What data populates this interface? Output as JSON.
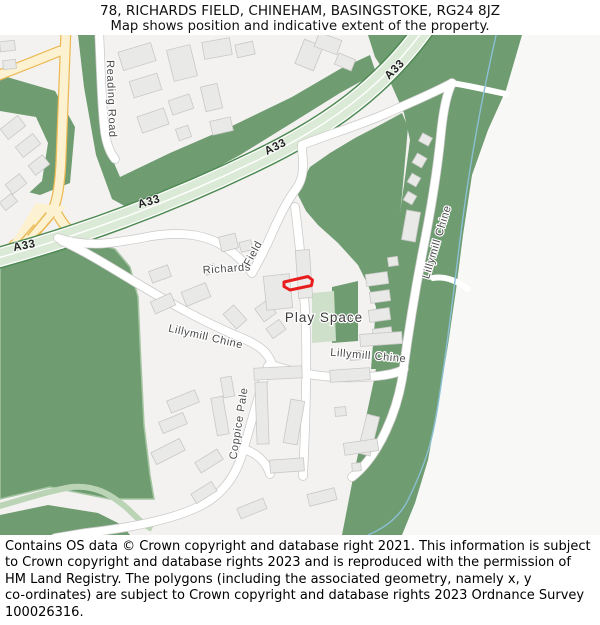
{
  "header": {
    "title": "78, RICHARDS FIELD, CHINEHAM, BASINGSTOKE, RG24 8JZ",
    "subtitle": "Map shows position and indicative extent of the property."
  },
  "map": {
    "road_labels": {
      "a33": "A33",
      "reading_road": "Reading Road",
      "richards": "Richards",
      "field": "Field",
      "lillymill_chine": "Lillymill Chine",
      "coppice_pale": "Coppice Pale"
    },
    "area_labels": {
      "play_space": "Play Space"
    },
    "colors": {
      "land": "#f3f2f0",
      "land_right": "#f8f8f7",
      "woodland": "#6f9c71",
      "woodland_edge": "#a5c5a2",
      "a33_fill": "#dbead6",
      "a33_casing": "#4e8a53",
      "road_fill": "#ffffff",
      "road_casing": "#cbcac9",
      "yellow_road_fill": "#fcf1d0",
      "yellow_road_casing": "#ecba55",
      "building_fill": "#e9e9e7",
      "building_stroke": "#c9c8c6",
      "play_space_fill": "#cfe0ca",
      "path_green": "#bad4b5",
      "stream": "#8bc0d2",
      "property_outline": "#e81e1e"
    },
    "property_outline_points": "284,247 308,241.5 312.5,245 311.5,250.5 290,255 284,251.5",
    "buildings": [
      [
        120,
        12,
        34,
        19,
        -17
      ],
      [
        131,
        42,
        29,
        17,
        -17
      ],
      [
        170,
        12,
        24,
        32,
        -14
      ],
      [
        203,
        5,
        28,
        17,
        -10
      ],
      [
        236,
        8,
        18,
        13,
        -12
      ],
      [
        139,
        77,
        28,
        17,
        -19
      ],
      [
        170,
        62,
        22,
        15,
        -19
      ],
      [
        177,
        92,
        13,
        12,
        -19
      ],
      [
        203,
        50,
        17,
        25,
        -13
      ],
      [
        211,
        84,
        21,
        14,
        -13
      ],
      [
        299,
        7,
        20,
        26,
        22
      ],
      [
        316,
        1,
        24,
        15,
        20
      ],
      [
        336,
        21,
        18,
        12,
        22
      ],
      [
        0,
        6,
        15,
        10,
        -6
      ],
      [
        3,
        25,
        13,
        9,
        -6
      ],
      [
        2,
        86,
        22,
        13,
        -38
      ],
      [
        17,
        104,
        22,
        13,
        -38
      ],
      [
        30,
        124,
        18,
        12,
        -38
      ],
      [
        7,
        143,
        18,
        12,
        -38
      ],
      [
        1,
        162,
        15,
        10,
        -38
      ],
      [
        150,
        233,
        20,
        12,
        -20
      ],
      [
        183,
        252,
        26,
        15,
        -22
      ],
      [
        152,
        262,
        22,
        13,
        -24
      ],
      [
        220,
        200,
        17,
        15,
        -14
      ],
      [
        240,
        206,
        12,
        10,
        -14
      ],
      [
        228,
        272,
        14,
        20,
        -42
      ],
      [
        258,
        268,
        15,
        16,
        -36
      ],
      [
        265,
        240,
        26,
        34,
        -6
      ],
      [
        297,
        215,
        14,
        48,
        -4
      ],
      [
        268,
        288,
        16,
        12,
        -36
      ],
      [
        205,
        230,
        10,
        9,
        -16
      ],
      [
        366,
        238,
        22,
        12,
        -8
      ],
      [
        370,
        256,
        20,
        11,
        -8
      ],
      [
        369,
        274,
        21,
        12,
        -8
      ],
      [
        373,
        293,
        19,
        11,
        -8
      ],
      [
        388,
        222,
        10,
        9,
        -8
      ],
      [
        414,
        120,
        11,
        11,
        30
      ],
      [
        409,
        140,
        10,
        10,
        30
      ],
      [
        405,
        158,
        10,
        10,
        30
      ],
      [
        420,
        100,
        11,
        9,
        28
      ],
      [
        404,
        176,
        14,
        30,
        10
      ],
      [
        168,
        360,
        30,
        13,
        -22
      ],
      [
        160,
        382,
        26,
        12,
        -22
      ],
      [
        152,
        410,
        32,
        13,
        -27
      ],
      [
        196,
        420,
        26,
        12,
        -32
      ],
      [
        214,
        362,
        12,
        38,
        -10
      ],
      [
        222,
        342,
        11,
        20,
        -10
      ],
      [
        254,
        332,
        48,
        12,
        -3
      ],
      [
        256,
        347,
        12,
        62,
        -2
      ],
      [
        287,
        365,
        14,
        44,
        10
      ],
      [
        270,
        424,
        34,
        13,
        -4
      ],
      [
        330,
        334,
        40,
        12,
        -4
      ],
      [
        362,
        380,
        13,
        40,
        14
      ],
      [
        344,
        406,
        34,
        12,
        -8
      ],
      [
        335,
        372,
        11,
        9,
        -5
      ],
      [
        352,
        428,
        9,
        8,
        -5
      ],
      [
        308,
        456,
        28,
        12,
        -14
      ],
      [
        238,
        468,
        28,
        11,
        -22
      ],
      [
        192,
        452,
        24,
        11,
        -32
      ],
      [
        360,
        298,
        42,
        12,
        -4
      ],
      [
        350,
        316,
        12,
        9,
        -4
      ]
    ]
  },
  "footer": {
    "lines": [
      "Contains OS data © Crown copyright and database right 2021. This information is subject",
      "to Crown copyright and database rights 2023 and is reproduced with the permission of",
      "HM Land Registry. The polygons (including the associated geometry, namely x, y",
      "co-ordinates) are subject to Crown copyright and database rights 2023 Ordnance Survey",
      "100026316."
    ]
  }
}
